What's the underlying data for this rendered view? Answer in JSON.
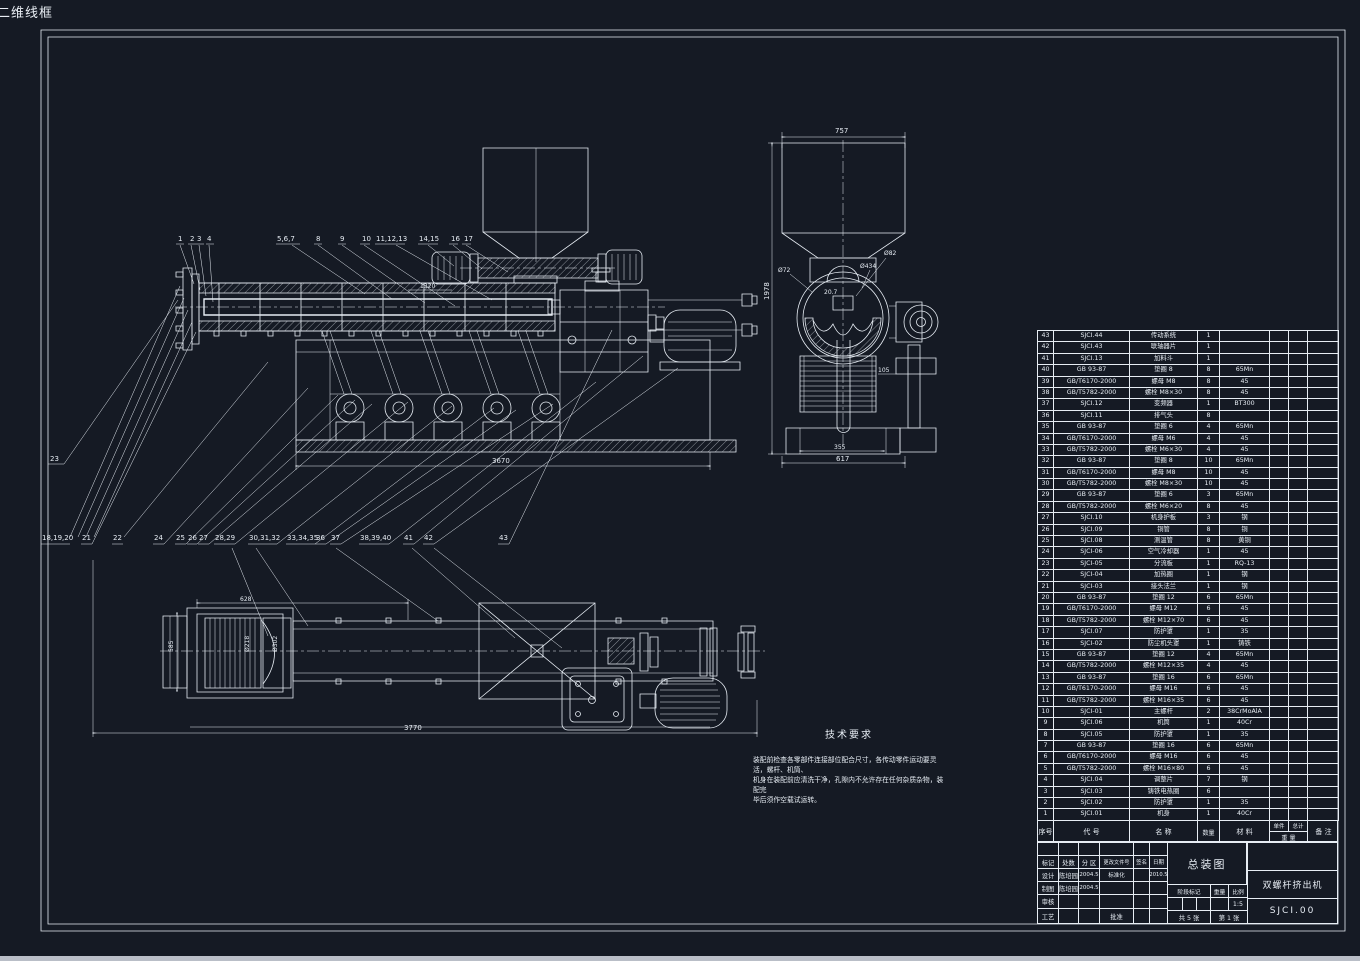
{
  "viewport_label": "二维线框",
  "colors": {
    "background": "#151a24",
    "line": "#e7edf4",
    "bottom_bar": "#b9bec7"
  },
  "drawing": {
    "callouts": {
      "top": [
        "1",
        "2",
        "3",
        "4",
        "5,6,7",
        "8",
        "9",
        "10",
        "11,12,13",
        "14,15",
        "16",
        "17"
      ],
      "mid": [
        "18,19,20",
        "21",
        "22",
        "24",
        "25",
        "26",
        "27",
        "28,29",
        "30,31,32",
        "33,34,35",
        "36",
        "37",
        "38,39,40",
        "41",
        "42",
        "43"
      ],
      "extra": "23"
    },
    "dims": {
      "main_total": "3670",
      "feed_length": "1320",
      "front_width": "757",
      "front_height": "1978",
      "front_base_inner": "355",
      "front_base": "617",
      "front_offset": "105",
      "dia_bore": "Ø72",
      "dia_outer": "Ø434",
      "dia_vent": "Ø82",
      "trough_depth": "20.7",
      "plan_width": "628",
      "plan_depth": "585",
      "plan_dia_barrel": "Ø218",
      "plan_dia_flange": "Ø302",
      "plan_total": "3770"
    },
    "tech_req": {
      "title": "技术要求",
      "lines": [
        "装配前检查各零部件连接部位配合尺寸，各传动零件运动要灵活，螺杆、机筒、",
        "机身在装配前应清洗干净，孔隙内不允许存在任何杂质杂物，装配完",
        "毕后须作空载试运转。"
      ]
    }
  },
  "bom": {
    "headers": {
      "no": "序号",
      "code": "代  号",
      "name": "名  称",
      "qty": "数量",
      "material": "材  料",
      "unit": "单件",
      "total": "总计",
      "weight": "重  量",
      "note": "备  注"
    },
    "rows": [
      {
        "no": "43",
        "code": "SJCI.44",
        "name": "传动系统",
        "qty": "1",
        "mat": ""
      },
      {
        "no": "42",
        "code": "SJCI.43",
        "name": "联轴器片",
        "qty": "1",
        "mat": ""
      },
      {
        "no": "41",
        "code": "SJCI.13",
        "name": "加料斗",
        "qty": "1",
        "mat": ""
      },
      {
        "no": "40",
        "code": "GB 93-87",
        "name": "垫圈 8",
        "qty": "8",
        "mat": "65Mn"
      },
      {
        "no": "39",
        "code": "GB/T6170-2000",
        "name": "螺母 M8",
        "qty": "8",
        "mat": "45"
      },
      {
        "no": "38",
        "code": "GB/T5782-2000",
        "name": "螺栓 M8×30",
        "qty": "8",
        "mat": "45"
      },
      {
        "no": "37",
        "code": "SJCI.12",
        "name": "变频器",
        "qty": "1",
        "mat": "BT300"
      },
      {
        "no": "36",
        "code": "SJCI.11",
        "name": "排气头",
        "qty": "8",
        "mat": ""
      },
      {
        "no": "35",
        "code": "GB 93-87",
        "name": "垫圈 6",
        "qty": "4",
        "mat": "65Mn"
      },
      {
        "no": "34",
        "code": "GB/T6170-2000",
        "name": "螺母 M6",
        "qty": "4",
        "mat": "45"
      },
      {
        "no": "33",
        "code": "GB/T5782-2000",
        "name": "螺栓 M6×30",
        "qty": "4",
        "mat": "45"
      },
      {
        "no": "32",
        "code": "GB 93-87",
        "name": "垫圈 8",
        "qty": "10",
        "mat": "65Mn"
      },
      {
        "no": "31",
        "code": "GB/T6170-2000",
        "name": "螺母 M8",
        "qty": "10",
        "mat": "45"
      },
      {
        "no": "30",
        "code": "GB/T5782-2000",
        "name": "螺栓 M8×30",
        "qty": "10",
        "mat": "45"
      },
      {
        "no": "29",
        "code": "GB 93-87",
        "name": "垫圈 6",
        "qty": "3",
        "mat": "65Mn"
      },
      {
        "no": "28",
        "code": "GB/T5782-2000",
        "name": "螺栓 M6×20",
        "qty": "8",
        "mat": "45"
      },
      {
        "no": "27",
        "code": "SJCI.10",
        "name": "机身护板",
        "qty": "3",
        "mat": "钢"
      },
      {
        "no": "26",
        "code": "SJCI.09",
        "name": "铜管",
        "qty": "8",
        "mat": "铜"
      },
      {
        "no": "25",
        "code": "SJCI.08",
        "name": "测温管",
        "qty": "8",
        "mat": "黄铜"
      },
      {
        "no": "24",
        "code": "SJCI-06",
        "name": "空气冷却器",
        "qty": "1",
        "mat": "45"
      },
      {
        "no": "23",
        "code": "SJCI-05",
        "name": "分流板",
        "qty": "1",
        "mat": "RQ-13"
      },
      {
        "no": "22",
        "code": "SJCI-04",
        "name": "加热圈",
        "qty": "1",
        "mat": "钢"
      },
      {
        "no": "21",
        "code": "SJCI-03",
        "name": "接头法兰",
        "qty": "1",
        "mat": "钢"
      },
      {
        "no": "20",
        "code": "GB 93-87",
        "name": "垫圈 12",
        "qty": "6",
        "mat": "65Mn"
      },
      {
        "no": "19",
        "code": "GB/T6170-2000",
        "name": "螺母 M12",
        "qty": "6",
        "mat": "45"
      },
      {
        "no": "18",
        "code": "GB/T5782-2000",
        "name": "螺栓 M12×70",
        "qty": "6",
        "mat": "45"
      },
      {
        "no": "17",
        "code": "SJCI.07",
        "name": "防护罩",
        "qty": "1",
        "mat": "35"
      },
      {
        "no": "16",
        "code": "SJCI-02",
        "name": "防尘机头罩",
        "qty": "1",
        "mat": "铸铁"
      },
      {
        "no": "15",
        "code": "GB 93-87",
        "name": "垫圈 12",
        "qty": "4",
        "mat": "65Mn"
      },
      {
        "no": "14",
        "code": "GB/T5782-2000",
        "name": "螺栓 M12×35",
        "qty": "4",
        "mat": "45"
      },
      {
        "no": "13",
        "code": "GB 93-87",
        "name": "垫圈 16",
        "qty": "6",
        "mat": "65Mn"
      },
      {
        "no": "12",
        "code": "GB/T6170-2000",
        "name": "螺母 M16",
        "qty": "6",
        "mat": "45"
      },
      {
        "no": "11",
        "code": "GB/T5782-2000",
        "name": "螺栓 M16×35",
        "qty": "6",
        "mat": "45"
      },
      {
        "no": "10",
        "code": "SJCI-01",
        "name": "主螺杆",
        "qty": "2",
        "mat": "38CrMoAlA"
      },
      {
        "no": "9",
        "code": "SJCI.06",
        "name": "机筒",
        "qty": "1",
        "mat": "40Cr"
      },
      {
        "no": "8",
        "code": "SJCI.05",
        "name": "防护罩",
        "qty": "1",
        "mat": "35"
      },
      {
        "no": "7",
        "code": "GB 93-87",
        "name": "垫圈 16",
        "qty": "6",
        "mat": "65Mn"
      },
      {
        "no": "6",
        "code": "GB/T6170-2000",
        "name": "螺母 M16",
        "qty": "6",
        "mat": "45"
      },
      {
        "no": "5",
        "code": "GB/T5782-2000",
        "name": "螺栓 M16×80",
        "qty": "6",
        "mat": "45"
      },
      {
        "no": "4",
        "code": "SJCI.04",
        "name": "调整片",
        "qty": "7",
        "mat": "钢"
      },
      {
        "no": "3",
        "code": "SJCI.03",
        "name": "铸铁电热圈",
        "qty": "6",
        "mat": ""
      },
      {
        "no": "2",
        "code": "SJCI.02",
        "name": "防护罩",
        "qty": "1",
        "mat": "35"
      },
      {
        "no": "1",
        "code": "SJCI.01",
        "name": "机身",
        "qty": "1",
        "mat": "40Cr"
      }
    ]
  },
  "titleblock": {
    "rev_headers": [
      "标记",
      "处数",
      "分 区",
      "更改文件号",
      "签名",
      "日期"
    ],
    "design_label": "设计",
    "design_name": "陈培园",
    "design_date": "2004.5",
    "std_label": "标准化",
    "std_date": "2010.5",
    "draft_label": "制图",
    "draft_name": "陈培园",
    "draft_date": "2004.5",
    "check_label": "审核",
    "process_label": "工艺",
    "approve_label": "批准",
    "title": "总装图",
    "stage_label": "阶段标记",
    "weight_label": "重量",
    "scale_label": "比例",
    "scale": "1:5",
    "sheets": "共 5 张",
    "sheet_no": "第 1 张",
    "product": "双螺杆挤出机",
    "code": "SJCI.00"
  }
}
